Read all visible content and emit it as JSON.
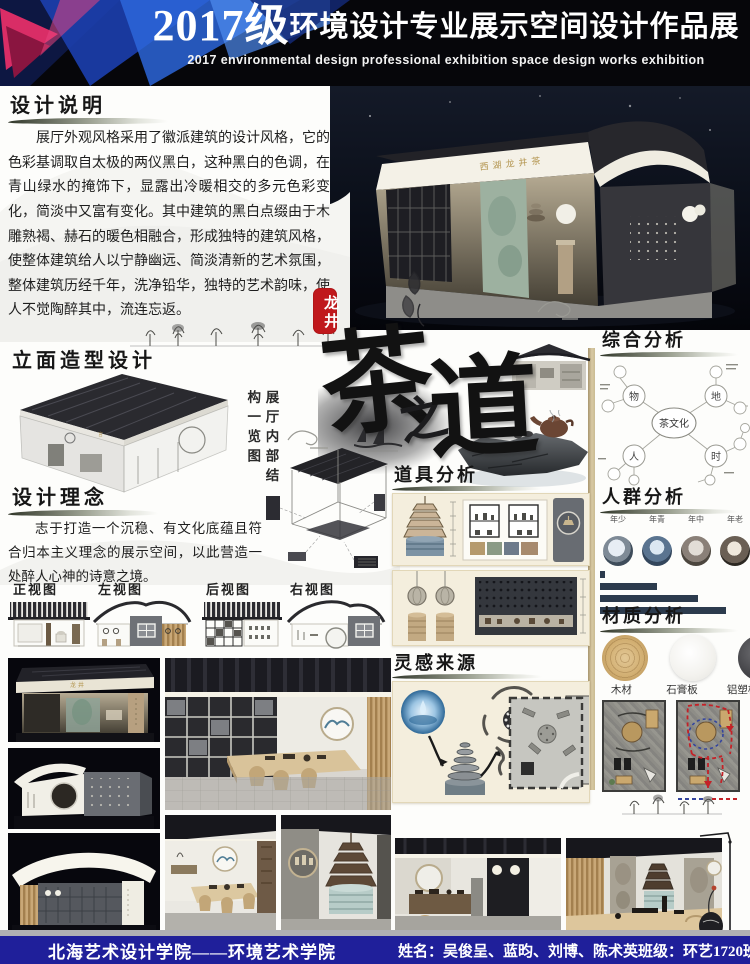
{
  "header": {
    "year": "2017级",
    "title_cn": "环境设计专业展示空间设计作品展",
    "title_en": "2017 environmental design professional exhibition space design works exhibition"
  },
  "hero": {
    "sign_text": "西湖龙井茶"
  },
  "seal": {
    "text": "龙井"
  },
  "calligraphy": {
    "char1": "茶",
    "char2": "之",
    "char3": "道"
  },
  "left": {
    "design_desc": {
      "heading": "设计说明",
      "body": "展厅外观风格采用了徽派建筑的设计风格，它的色彩基调取自太极的两仪黑白，这种黑白的色调，在青山绿水的掩饰下，显露出冷暖相交的多元色彩变化，简淡中又富有变化。其中建筑的黑白点缀由于木雕熟褐、赫石的暖色相融合，形成独特的建筑风格，使整体建筑给人以宁静幽远、简淡清新的艺术氛围，整体建筑历经千年，洗净铅华，独特的艺术韵味，使人不觉陶醉其中，流连忘返。"
    },
    "facade": {
      "heading": "立面造型设计",
      "note_vertical": "展厅内部结构一览图"
    },
    "concept": {
      "heading": "设计理念",
      "body": "志于打造一个沉稳、有文化底蕴且符合归本主义理念的展示空间，以此营造一处醉人心神的诗意之境。"
    }
  },
  "center": {
    "props_heading": "道具分析",
    "inspiration_heading": "灵感来源"
  },
  "right": {
    "comprehensive": {
      "heading": "综合分析",
      "center": "茶文化",
      "branches": [
        "物",
        "地",
        "人",
        "时"
      ]
    },
    "crowd": {
      "heading": "人群分析",
      "categories": [
        "少年",
        "青年",
        "中年",
        "老年"
      ]
    },
    "material": {
      "heading": "材质分析",
      "items": [
        "木材",
        "石膏板",
        "铝塑板"
      ]
    }
  },
  "elevations": {
    "labels": [
      "正视图",
      "左视图",
      "后视图",
      "右视图"
    ]
  },
  "footer": {
    "school": "北海艺术设计学院——环境艺术学院",
    "names": "姓名：吴俊呈、蓝昀、刘博、陈术英",
    "class_name": "班级：环艺1720班"
  },
  "chart_data": {
    "type": "bar",
    "title": "人群分析",
    "orientation": "horizontal",
    "categories": [
      "少年",
      "青年",
      "中年",
      "老年"
    ],
    "values": [
      3,
      38,
      65,
      84
    ],
    "unit": "relative share, axis unlabeled",
    "bar_color": "#2c3b4d",
    "legend": false
  },
  "colors": {
    "seal_red": "#c0181c",
    "footer_navy": "#1f1f9a",
    "panel_cream": "#f4eedd",
    "bar_navy": "#2c3b4d",
    "header_black": "#06060a",
    "accent_blue": "#2d66d9",
    "accent_magenta": "#d92d66"
  }
}
